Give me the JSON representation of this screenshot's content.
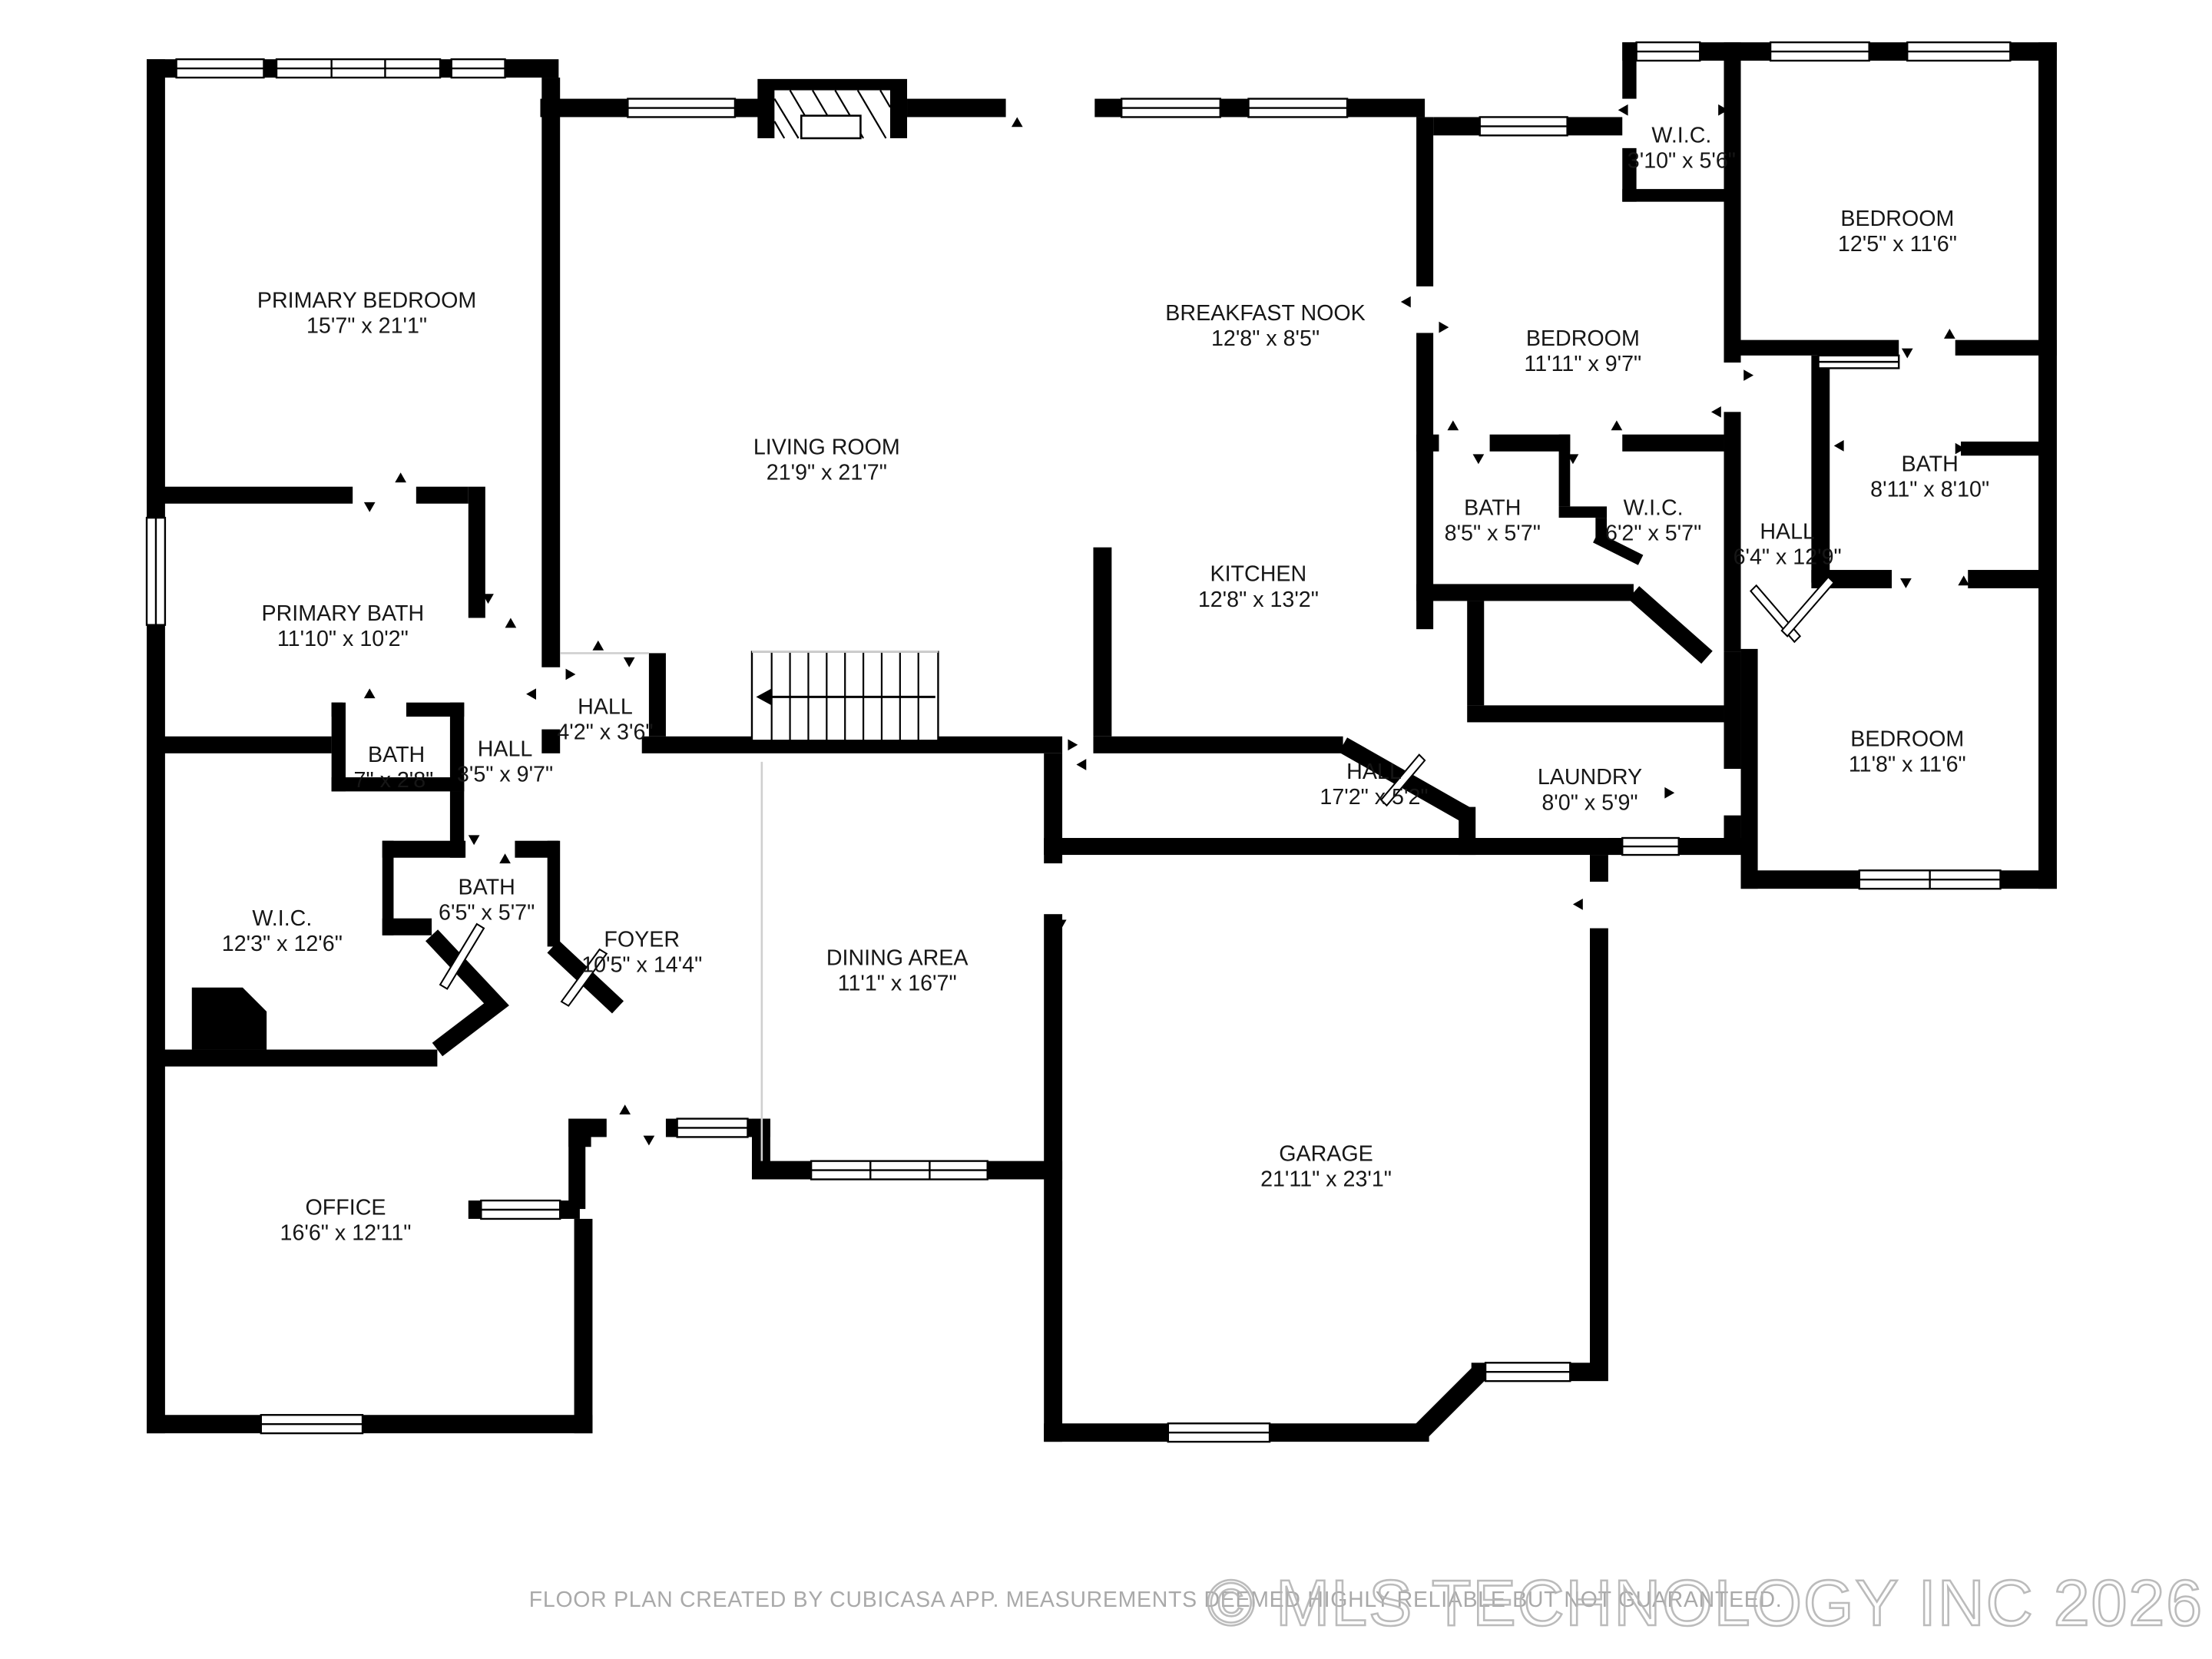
{
  "floor_plan": {
    "source_note": "FLOOR PLAN CREATED BY CUBICASA APP. MEASUREMENTS DEEMED HIGHLY RELIABLE BUT NOT GUARANTEED.",
    "watermark": "© MLS TECHNOLOGY INC 2026",
    "colors": {
      "wall": "#000000",
      "label": "#161616",
      "footer_gray": "#a9a9a9",
      "watermark_gray": "#b4b4b4"
    },
    "rooms": [
      {
        "name": "PRIMARY BEDROOM",
        "dims": "15'7\" x 21'1\""
      },
      {
        "name": "PRIMARY BATH",
        "dims": "11'10\" x 10'2\""
      },
      {
        "name": "BATH",
        "dims": "7\" x 2'8\""
      },
      {
        "name": "HALL",
        "dims": "3'5\" x 9'7\""
      },
      {
        "name": "HALL",
        "dims": "4'2\" x 3'6\""
      },
      {
        "name": "W.I.C.",
        "dims": "12'3\" x 12'6\""
      },
      {
        "name": "BATH",
        "dims": "6'5\" x 5'7\""
      },
      {
        "name": "OFFICE",
        "dims": "16'6\" x 12'11\""
      },
      {
        "name": "FOYER",
        "dims": "10'5\" x 14'4\""
      },
      {
        "name": "DINING AREA",
        "dims": "11'1\" x 16'7\""
      },
      {
        "name": "LIVING ROOM",
        "dims": "21'9\" x 21'7\""
      },
      {
        "name": "BREAKFAST NOOK",
        "dims": "12'8\" x 8'5\""
      },
      {
        "name": "KITCHEN",
        "dims": "12'8\" x 13'2\""
      },
      {
        "name": "HALL",
        "dims": "17'2\" x 5'2\""
      },
      {
        "name": "LAUNDRY",
        "dims": "8'0\" x 5'9\""
      },
      {
        "name": "GARAGE",
        "dims": "21'11\" x 23'1\""
      },
      {
        "name": "W.I.C.",
        "dims": "3'10\" x 5'6\""
      },
      {
        "name": "BEDROOM",
        "dims": "11'11\" x 9'7\""
      },
      {
        "name": "BEDROOM",
        "dims": "12'5\" x 11'6\""
      },
      {
        "name": "BATH",
        "dims": "8'5\" x 5'7\""
      },
      {
        "name": "W.I.C.",
        "dims": "6'2\" x 5'7\""
      },
      {
        "name": "HALL",
        "dims": "6'4\" x 12'9\""
      },
      {
        "name": "BATH",
        "dims": "8'11\" x 8'10\""
      },
      {
        "name": "BEDROOM",
        "dims": "11'8\" x 11'6\""
      }
    ]
  }
}
